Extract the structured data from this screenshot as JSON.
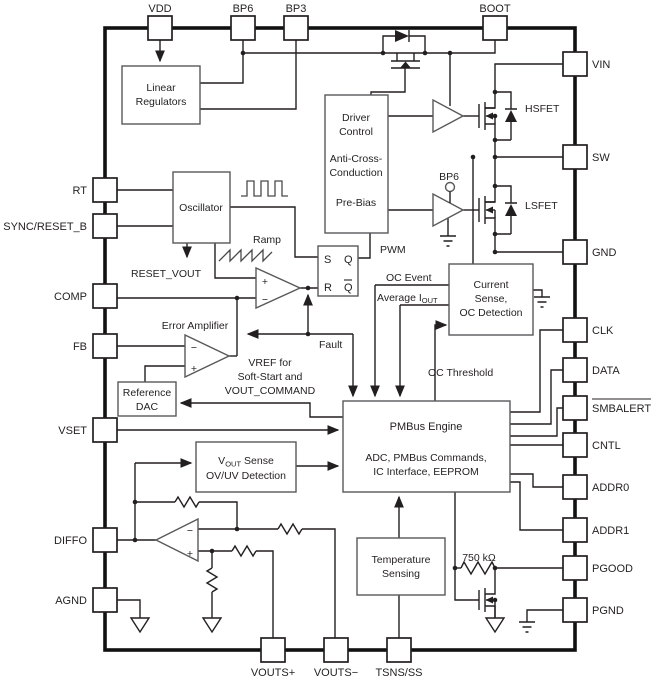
{
  "pins": {
    "top": [
      {
        "label": "VDD"
      },
      {
        "label": "BP6"
      },
      {
        "label": "BP3"
      },
      {
        "label": "BOOT"
      }
    ],
    "right": [
      {
        "label": "VIN"
      },
      {
        "label": "SW"
      },
      {
        "label": "GND"
      },
      {
        "label": "CLK"
      },
      {
        "label": "DATA"
      },
      {
        "label": "SMBALERT"
      },
      {
        "label": "CNTL"
      },
      {
        "label": "ADDR0"
      },
      {
        "label": "ADDR1"
      },
      {
        "label": "PGOOD"
      },
      {
        "label": "PGND"
      }
    ],
    "left": [
      {
        "label": "RT"
      },
      {
        "label": "SYNC/RESET_B"
      },
      {
        "label": "COMP"
      },
      {
        "label": "FB"
      },
      {
        "label": "VSET"
      },
      {
        "label": "DIFFO"
      },
      {
        "label": "AGND"
      }
    ],
    "bottom": [
      {
        "label": "VOUTS+"
      },
      {
        "label": "VOUTS−"
      },
      {
        "label": "TSNS/SS"
      }
    ]
  },
  "blocks": {
    "linear_regulators": {
      "lines": [
        "Linear",
        "Regulators"
      ]
    },
    "oscillator": {
      "label": "Oscillator"
    },
    "driver_control": {
      "lines": [
        "Driver",
        "Control",
        "Anti-Cross-",
        "Conduction",
        "Pre-Bias"
      ]
    },
    "pwm_latch": {
      "s": "S",
      "q": "Q",
      "r": "R",
      "qbar": "Q"
    },
    "current_sense": {
      "lines": [
        "Current",
        "Sense,",
        "OC Detection"
      ]
    },
    "reference_dac": {
      "lines": [
        "Reference",
        "DAC"
      ]
    },
    "pmbus_engine": {
      "title": "PMBus Engine",
      "lines": [
        "ADC, PMBus Commands,",
        "IC Interface, EEPROM"
      ]
    },
    "vout_sense": {
      "prefix": "V",
      "sub": "OUT",
      "suffix": "Sense",
      "line2": "OV/UV Detection"
    },
    "temperature_sensing": {
      "lines": [
        "Temperature",
        "Sensing"
      ]
    },
    "error_amplifier": {
      "label": "Error Amplifier"
    }
  },
  "signals": {
    "ramp": "Ramp",
    "reset_vout": "RESET_VOUT",
    "pwm": "PWM",
    "oc_event": "OC Event",
    "average_prefix": "Average I",
    "average_sub": "OUT",
    "fault": "Fault",
    "oc_threshold": "OC Threshold",
    "vref_lines": [
      "VREF for",
      "Soft-Start and",
      "VOUT_COMMAND"
    ],
    "bp6_supply": "BP6",
    "hsfet": "HSFET",
    "lsfet": "LSFET",
    "pullup_resistor": "750 kΩ"
  },
  "symbols": {
    "plus": "+",
    "minus": "−"
  },
  "colors": {
    "wire": "#231f20",
    "block_stroke": "#58595b",
    "background": "#ffffff"
  }
}
